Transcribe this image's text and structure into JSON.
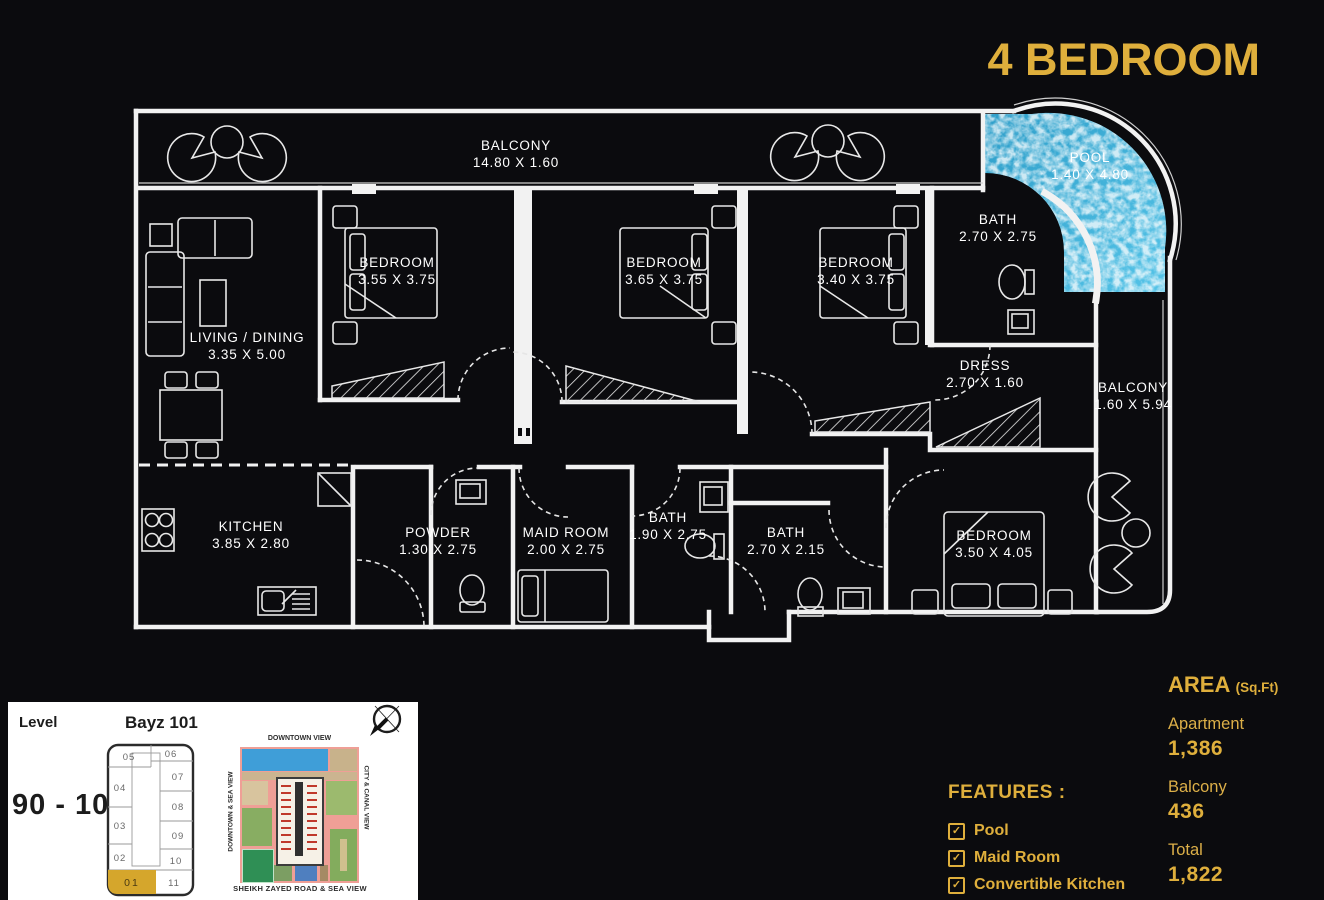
{
  "title": "4 BEDROOM",
  "colors": {
    "gold": "#DFAF3C",
    "background": "#0B0B0E",
    "wall_white": "#F2F2F2",
    "pool_blue": "#3FB4DF",
    "panel_white": "#FFFFFF",
    "unit_highlight_gold": "#D5A62C"
  },
  "plan": {
    "rooms": [
      {
        "name": "BALCONY",
        "dims": "14.80 X 1.60"
      },
      {
        "name": "POOL",
        "dims": "1.40 X 4.80"
      },
      {
        "name": "BATH",
        "dims": "2.70 X 2.75"
      },
      {
        "name": "BEDROOM",
        "dims": "3.55 X 3.75"
      },
      {
        "name": "BEDROOM",
        "dims": "3.65 X 3.75"
      },
      {
        "name": "BEDROOM",
        "dims": "3.40 X 3.75"
      },
      {
        "name": "LIVING / DINING",
        "dims": "3.35 X 5.00"
      },
      {
        "name": "DRESS",
        "dims": "2.70 X 1.60"
      },
      {
        "name": "BALCONY",
        "dims": "1.60 X 5.94"
      },
      {
        "name": "KITCHEN",
        "dims": "3.85 X 2.80"
      },
      {
        "name": "POWDER",
        "dims": "1.30 X 2.75"
      },
      {
        "name": "MAID ROOM",
        "dims": "2.00 X 2.75"
      },
      {
        "name": "BATH",
        "dims": "1.90 X 2.75"
      },
      {
        "name": "BATH",
        "dims": "2.70 X 2.15"
      },
      {
        "name": "BEDROOM",
        "dims": "3.50 X 4.05"
      }
    ]
  },
  "level_panel": {
    "level_label": "Level",
    "building_name": "Bayz 101",
    "level_range": "90 - 101",
    "units": [
      "05",
      "06",
      "07",
      "04",
      "08",
      "03",
      "09",
      "02",
      "10",
      "01",
      "11"
    ],
    "highlighted_unit": "01",
    "site_map": {
      "top": "DOWNTOWN VIEW",
      "left": "DOWNTOWN & SEA VIEW",
      "right": "CITY & CANAL VIEW",
      "bottom": "SHEIKH ZAYED ROAD & SEA VIEW"
    }
  },
  "features": {
    "heading": "FEATURES :",
    "items": [
      "Pool",
      "Maid Room",
      "Convertible Kitchen"
    ]
  },
  "area": {
    "heading": "AREA",
    "unit_suffix": "(Sq.Ft)",
    "rows": [
      {
        "label": "Apartment",
        "value": "1,386"
      },
      {
        "label": "Balcony",
        "value": "436"
      },
      {
        "label": "Total",
        "value": "1,822"
      }
    ]
  }
}
